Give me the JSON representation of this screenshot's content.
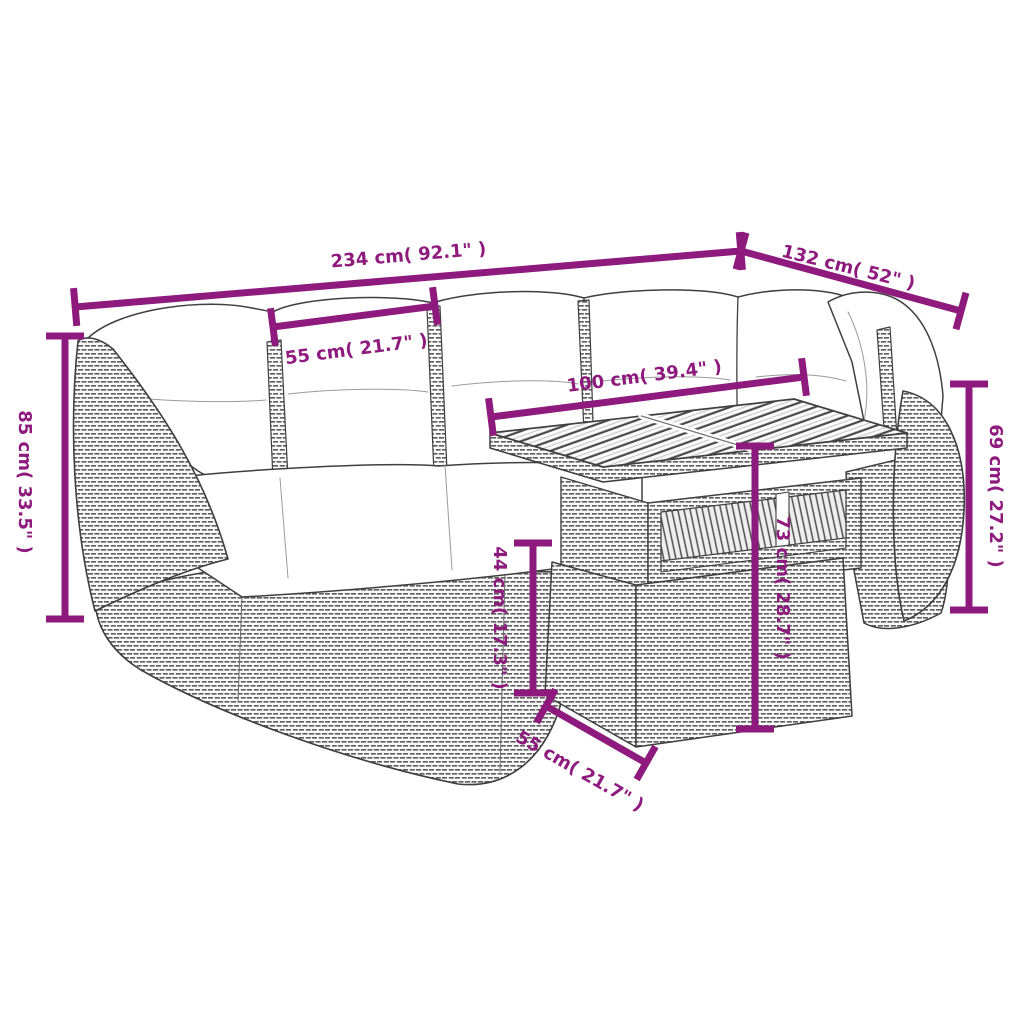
{
  "colors": {
    "dimension": "#8E1A7E",
    "line_art": "#3F3F3F",
    "cushion": "#FFFFFF",
    "background": "#FFFFFF"
  },
  "dims": {
    "total_width": "234 cm( 92.1\" )",
    "total_depth": "132 cm( 52\" )",
    "seat_width": "55 cm( 21.7\" )",
    "table_width": "100 cm( 39.4\" )",
    "sofa_height": "85 cm( 33.5\" )",
    "back_height": "69 cm( 27.2\" )",
    "seat_height": "44 cm( 17.3\" )",
    "table_height": "73 cm( 28.7\" )",
    "table_depth": "55 cm( 21.7\" )"
  }
}
